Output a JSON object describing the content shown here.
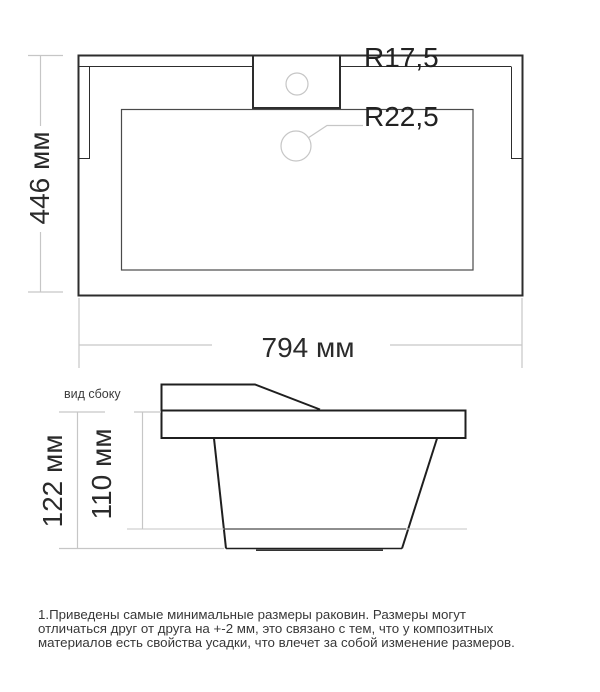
{
  "drawing": {
    "top_view": {
      "width_label": "794 мм",
      "height_label": "446 мм",
      "faucet_radius_label": "R17,5",
      "drain_radius_label": "R22,5"
    },
    "side_view": {
      "caption": "вид сбоку",
      "overall_height_label": "122 мм",
      "bowl_depth_label": "110 мм"
    },
    "colors": {
      "outline": "#2d2d2d",
      "inner_line": "#4a4a4a",
      "dimension_line": "#c6c6c6",
      "text": "#2a2a2a"
    }
  },
  "footer": {
    "line1": "1.Приведены самые минимальные размеры раковин. Размеры могут",
    "line2": "отличаться друг от друга на +-2 мм, это связано с тем, что у композитных",
    "line3": "материалов есть свойства усадки, что влечет за собой изменение размеров."
  }
}
